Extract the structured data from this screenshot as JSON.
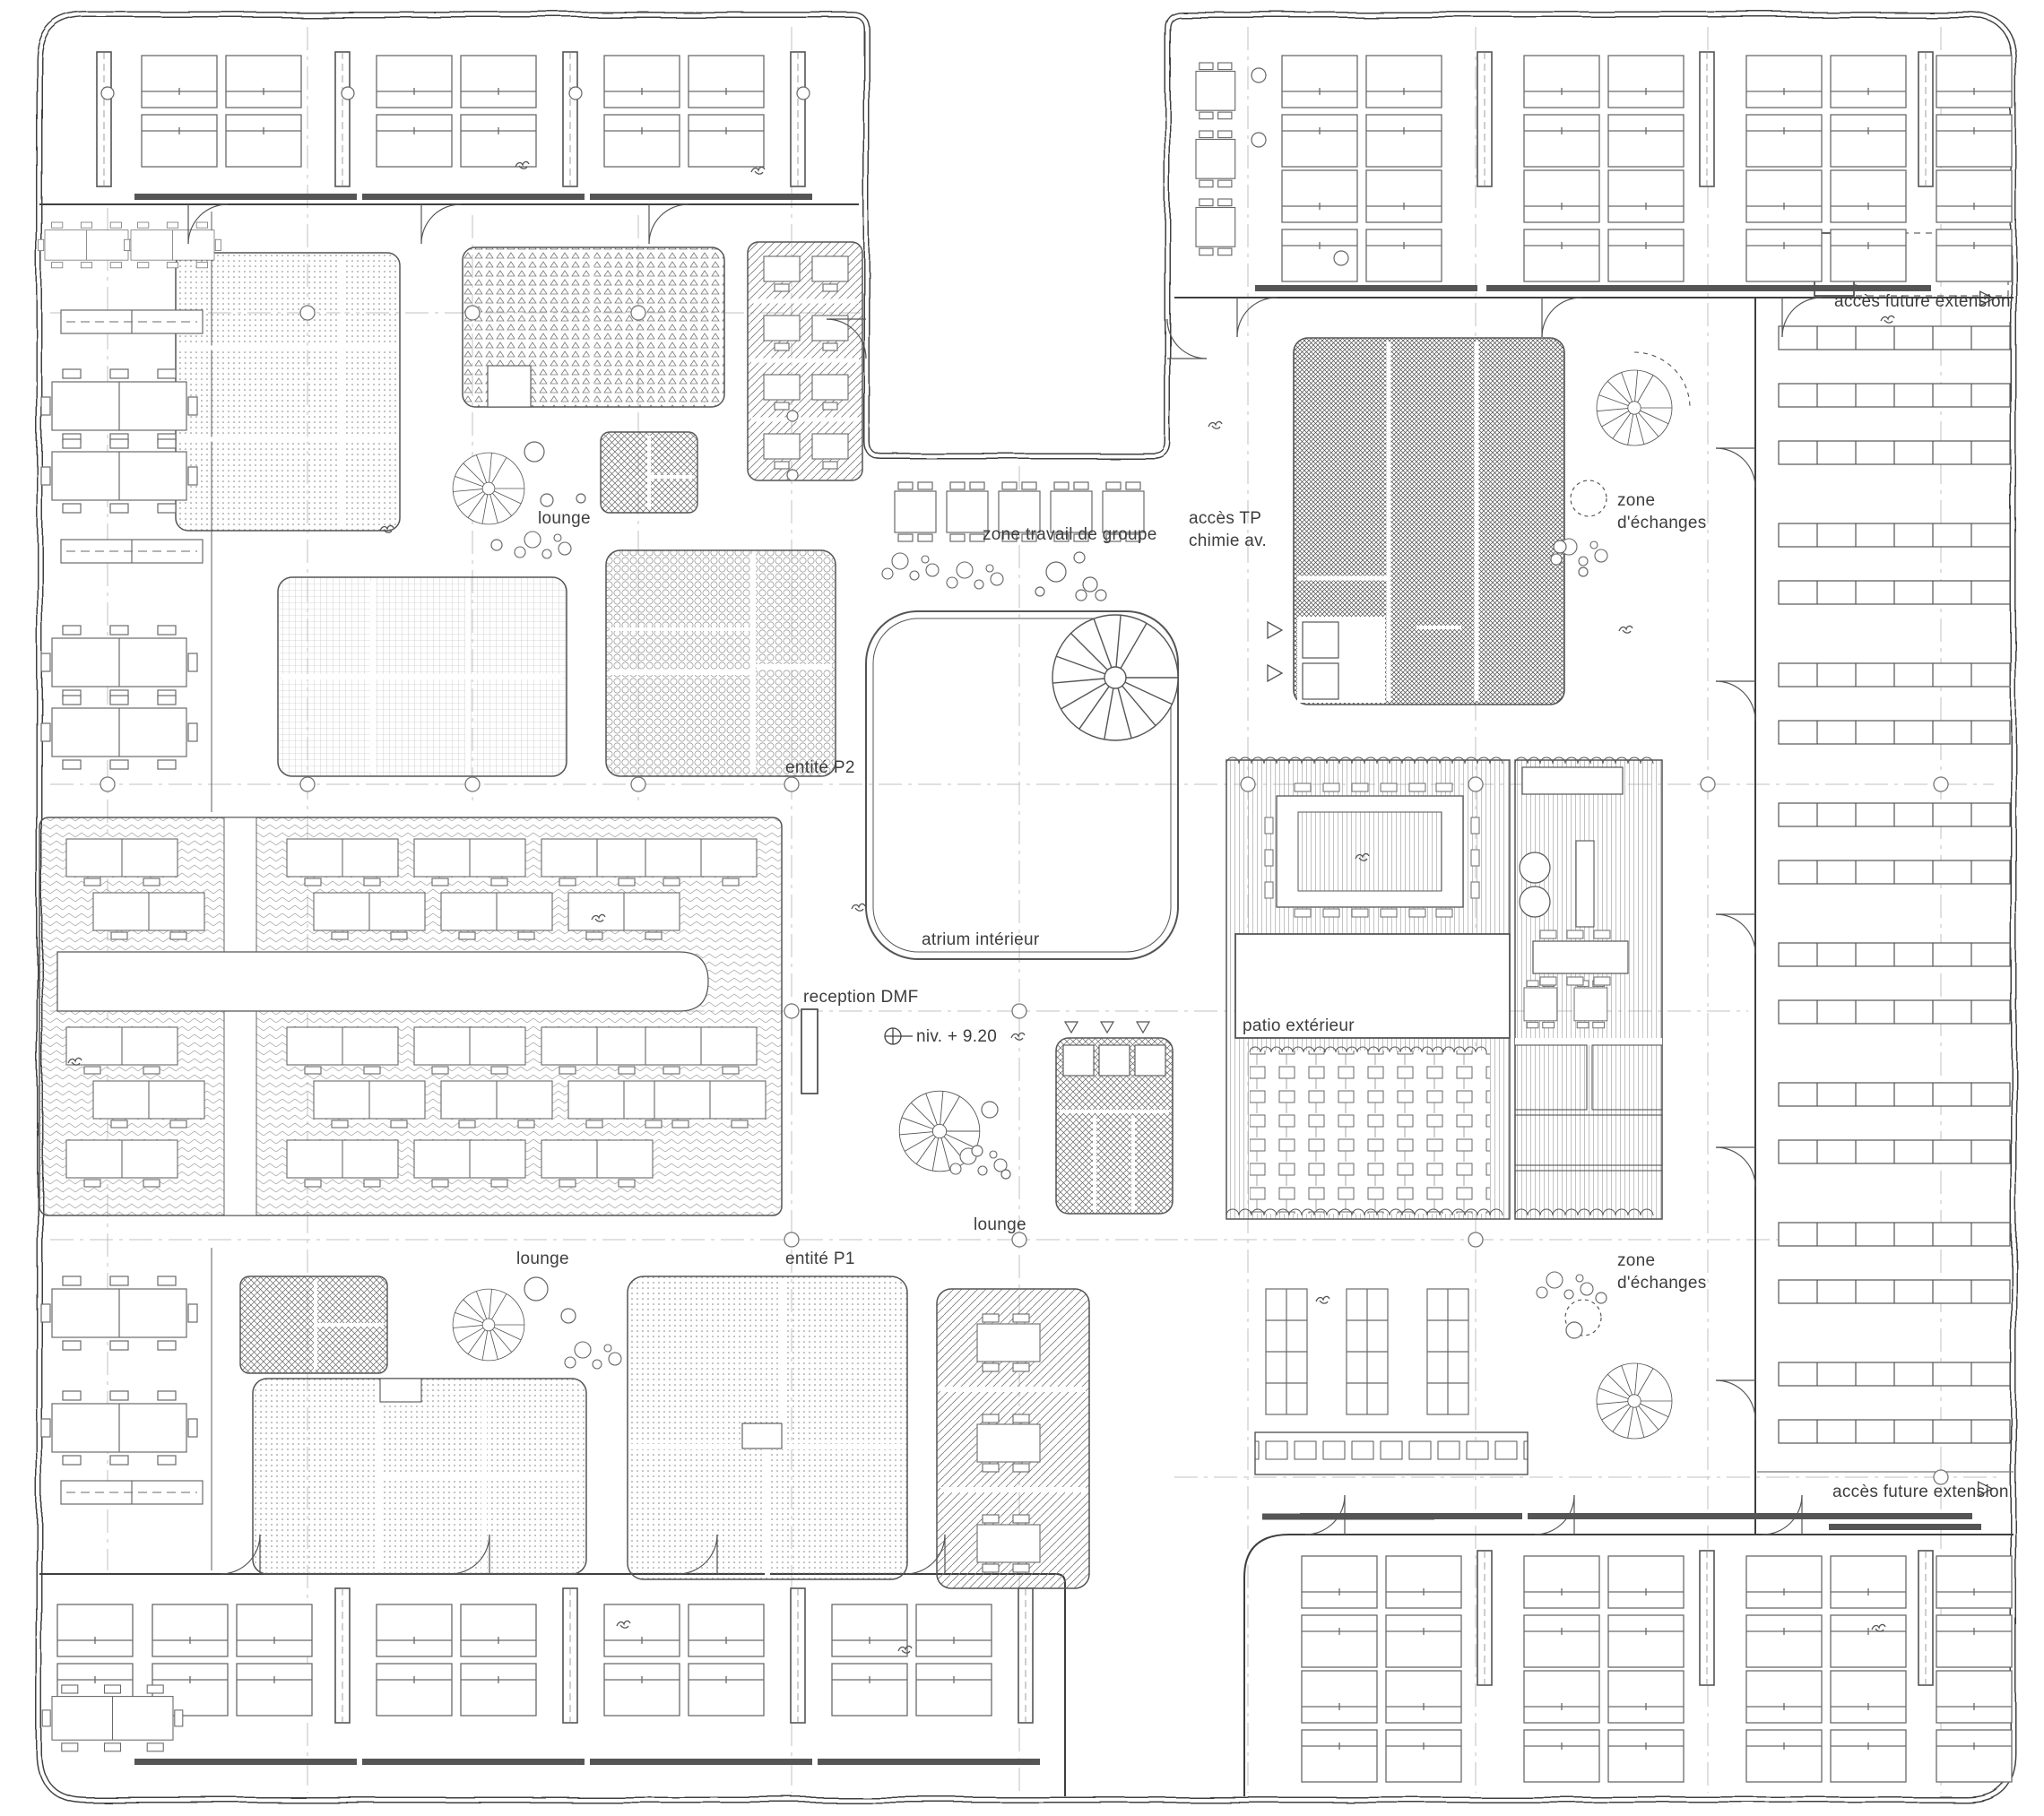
{
  "drawing": {
    "type": "architectural floor plan",
    "level_note": "niv. + 9.20"
  },
  "colors": {
    "ink": "#3f3f3f",
    "hatch": "#8a8a8a",
    "grid": "#909090",
    "background": "#ffffff"
  },
  "labels": {
    "acces_future_extension_top": "accès future extension",
    "acces_future_extension_bottom": "accès future extension",
    "lounge_top": "lounge",
    "lounge_center": "lounge",
    "lounge_bottom": "lounge",
    "zone_travail": "zone travail de groupe",
    "acces_tp": "accès TP\nchimie av.",
    "zone_echanges_top": "zone\nd'échanges",
    "zone_echanges_bottom": "zone\nd'échanges",
    "entite_p2": "entité P2",
    "entite_p1": "entité P1",
    "atrium": "atrium intérieur",
    "reception": "reception DMF",
    "niveau": "niv. + 9.20",
    "patio": "patio extérieur"
  },
  "icons": {
    "extension_arrow": "▷"
  }
}
